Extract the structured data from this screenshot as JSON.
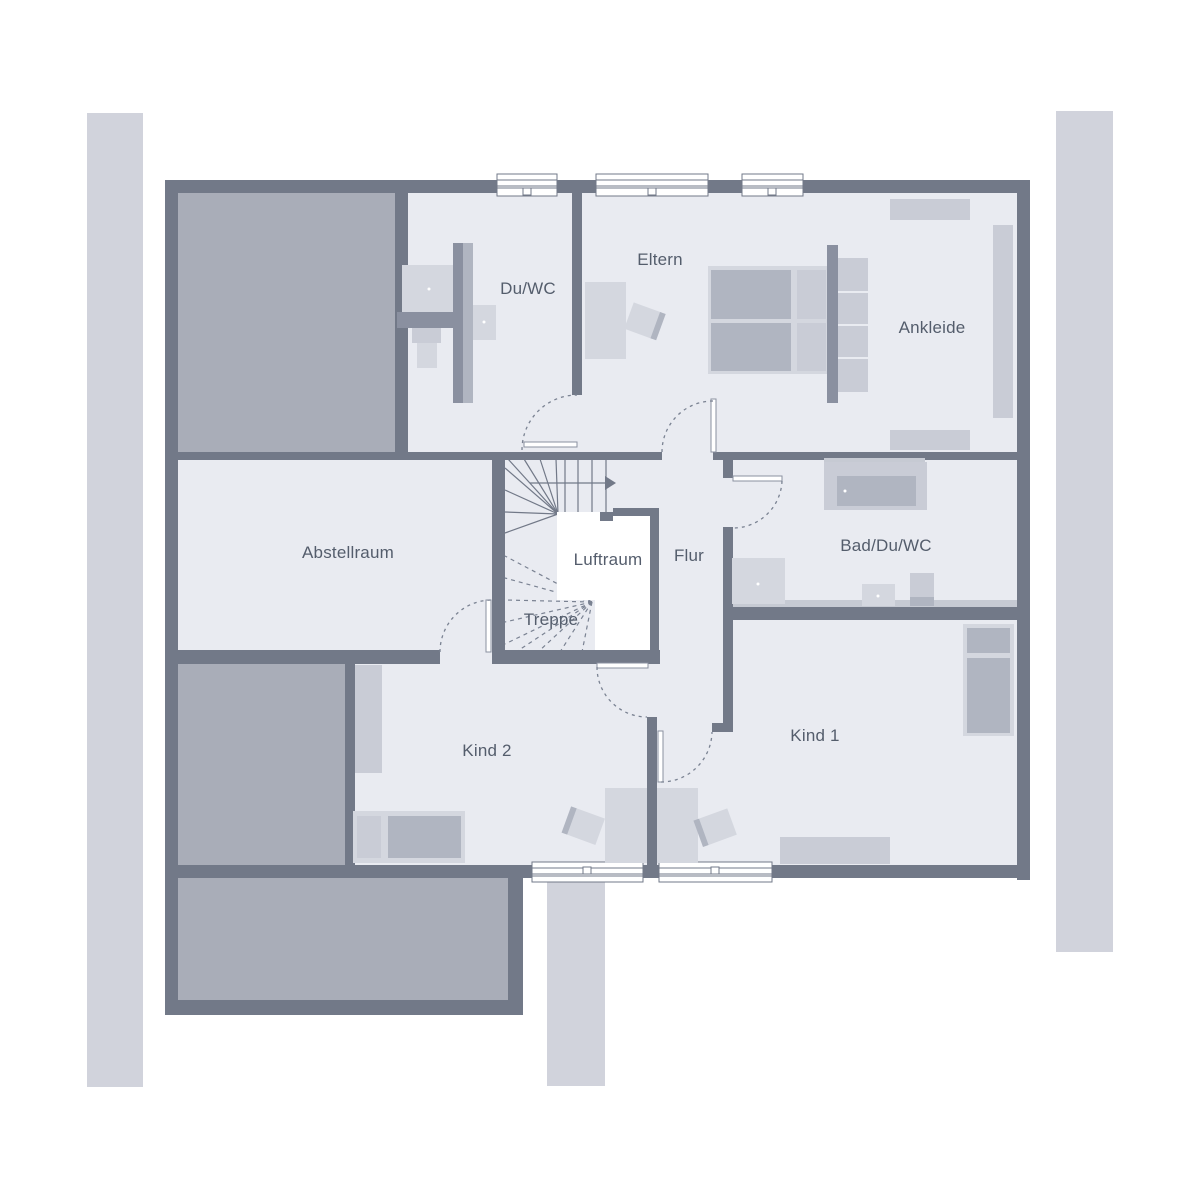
{
  "plan_type": "floor-plan",
  "rooms": [
    {
      "id": "du-wc",
      "label": "Du/WC"
    },
    {
      "id": "eltern",
      "label": "Eltern"
    },
    {
      "id": "ankleide",
      "label": "Ankleide"
    },
    {
      "id": "abstellraum",
      "label": "Abstellraum"
    },
    {
      "id": "luftraum",
      "label": "Luftraum"
    },
    {
      "id": "flur",
      "label": "Flur"
    },
    {
      "id": "bad-du-wc",
      "label": "Bad/Du/WC"
    },
    {
      "id": "treppe",
      "label": "Treppe"
    },
    {
      "id": "kind-2",
      "label": "Kind 2"
    },
    {
      "id": "kind-1",
      "label": "Kind 1"
    }
  ],
  "colors": {
    "wall": "#727988",
    "fill": "#e9ebf1",
    "roof": "#a9adb8",
    "strip": "#d1d3dc",
    "furn-light": "#d4d7df",
    "furn-mid": "#b0b5c1",
    "furn-soft": "#c9ccd6",
    "accent-bar": "#8a90a0",
    "band": "#c6cad3",
    "text": "#545d6c",
    "arc": "#7a8292"
  }
}
